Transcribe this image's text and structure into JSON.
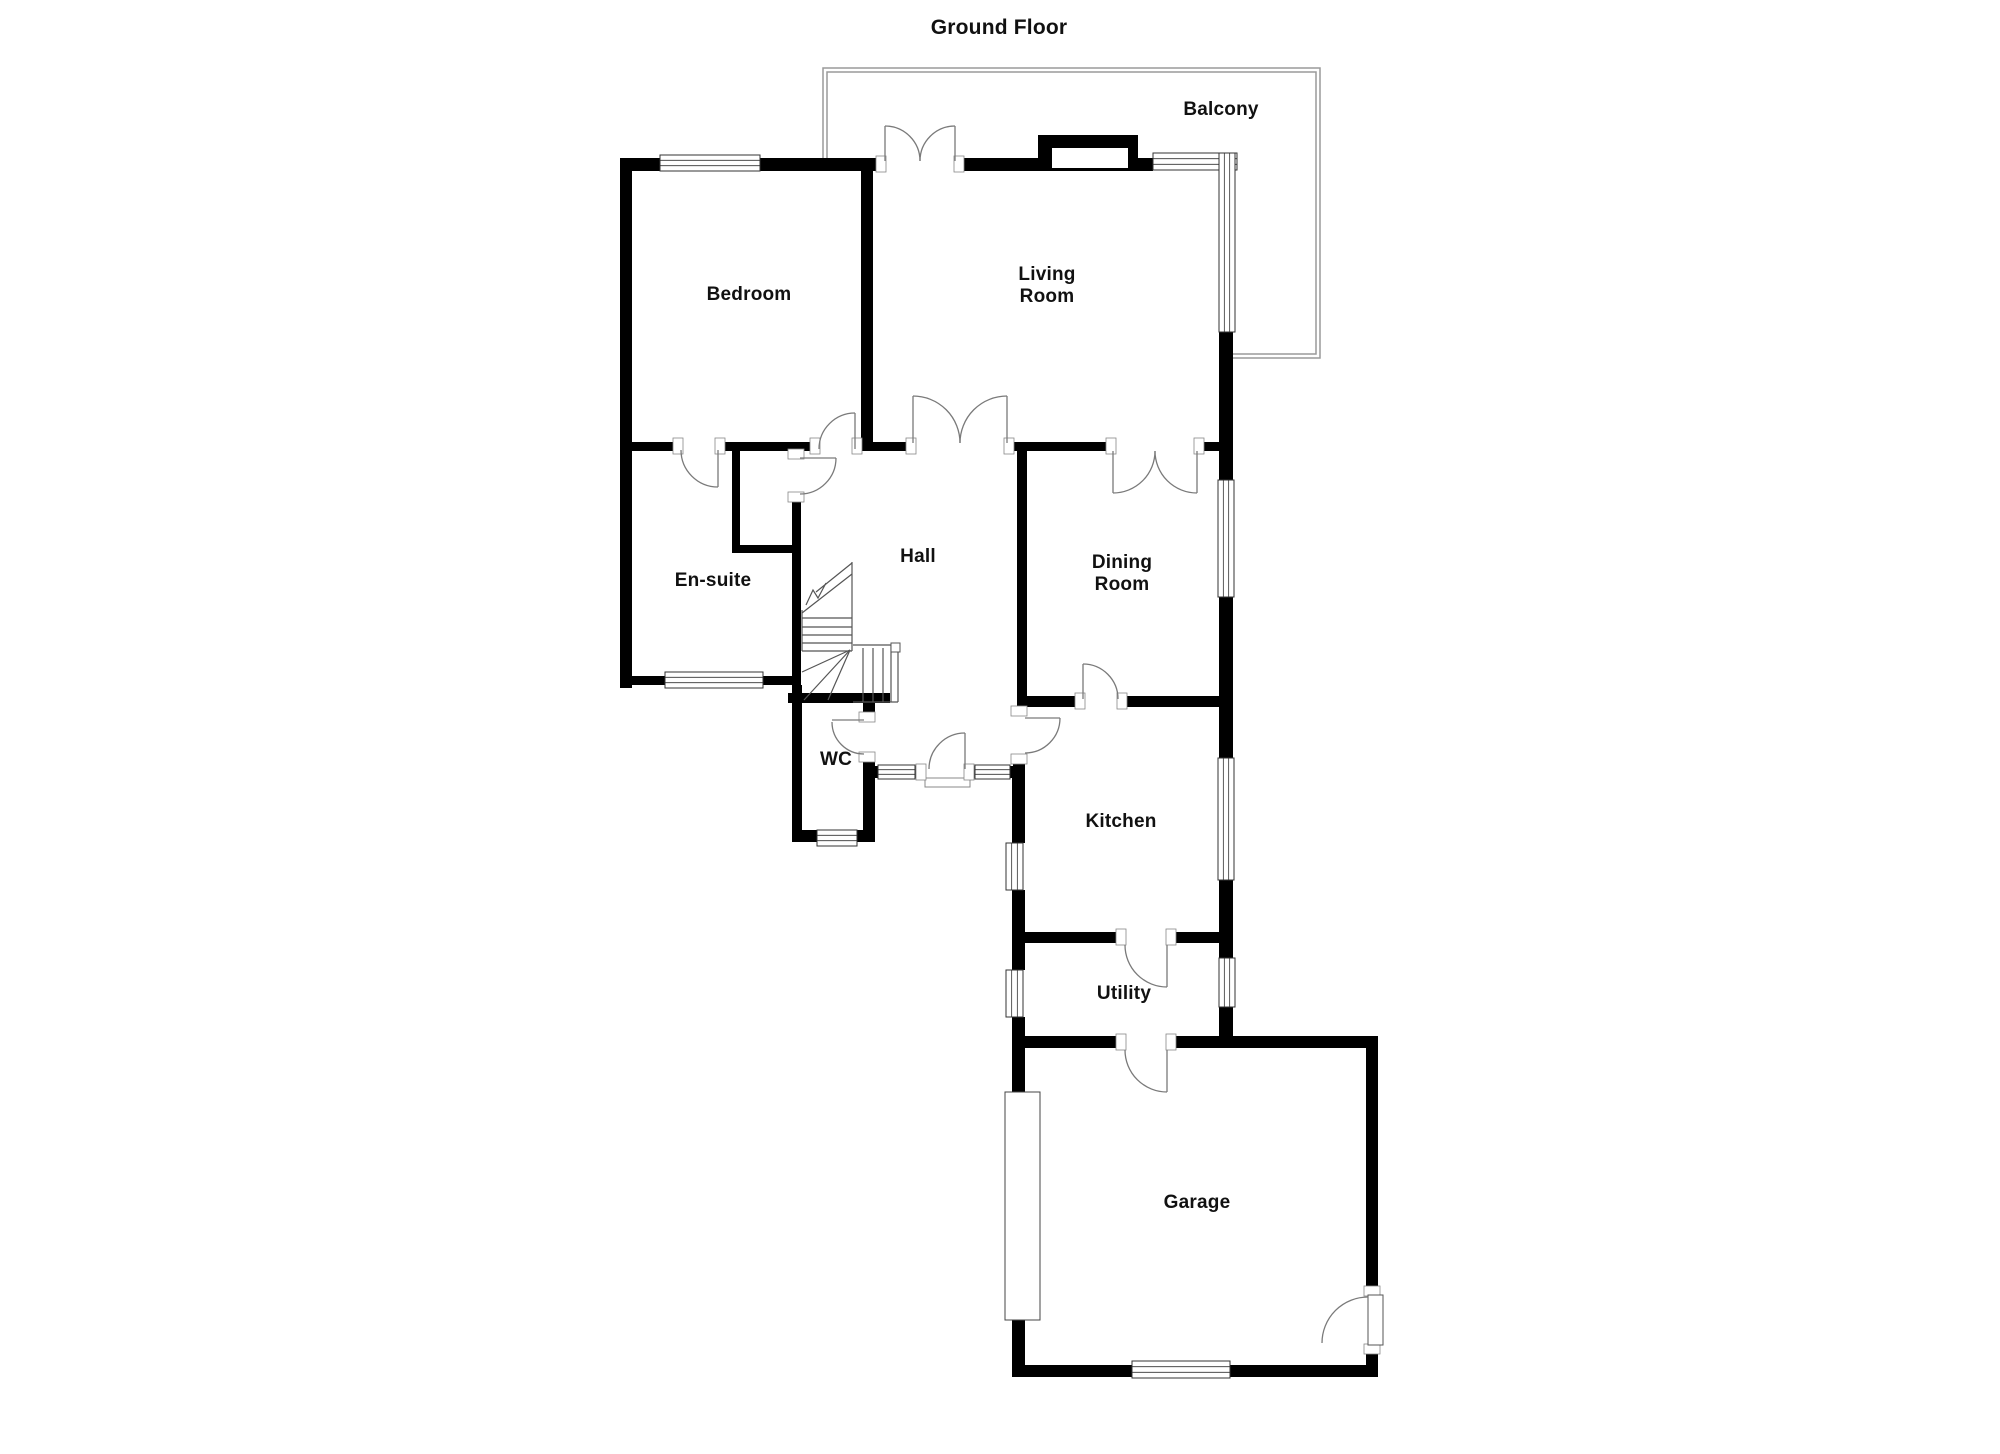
{
  "labels": [
    {
      "key": "title",
      "text": "Ground Floor",
      "x": 999,
      "y": 28
    },
    {
      "key": "balcony",
      "text": "Balcony",
      "x": 1221,
      "y": 110
    },
    {
      "key": "bedroom",
      "text": "Bedroom",
      "x": 749,
      "y": 295
    },
    {
      "key": "living",
      "text": "Living\nRoom",
      "x": 1047,
      "y": 286
    },
    {
      "key": "ensuite",
      "text": "En-suite",
      "x": 713,
      "y": 581
    },
    {
      "key": "hall",
      "text": "Hall",
      "x": 918,
      "y": 557
    },
    {
      "key": "dining",
      "text": "Dining\nRoom",
      "x": 1122,
      "y": 574
    },
    {
      "key": "wc",
      "text": "WC",
      "x": 836,
      "y": 760
    },
    {
      "key": "kitchen",
      "text": "Kitchen",
      "x": 1121,
      "y": 822
    },
    {
      "key": "utility",
      "text": "Utility",
      "x": 1124,
      "y": 994
    },
    {
      "key": "garage",
      "text": "Garage",
      "x": 1197,
      "y": 1203
    }
  ],
  "plan": {
    "background": "#ffffff",
    "wall_color": "#000000",
    "line_color": "#555555",
    "arc_color": "#7a7a7a",
    "window_color": "#333333",
    "balcony_color": "#9a9a9a",
    "walls": [
      [
        620,
        158,
        12,
        530
      ],
      [
        620,
        158,
        260,
        13
      ],
      [
        957,
        158,
        81,
        13
      ],
      [
        1138,
        158,
        15,
        13
      ],
      [
        861,
        168,
        12,
        283
      ],
      [
        620,
        442,
        60,
        9
      ],
      [
        718,
        442,
        99,
        9
      ],
      [
        855,
        442,
        58,
        9
      ],
      [
        1007,
        442,
        106,
        9
      ],
      [
        1197,
        442,
        36,
        9
      ],
      [
        732,
        450,
        8,
        103
      ],
      [
        732,
        545,
        66,
        8
      ],
      [
        792,
        450,
        9,
        8
      ],
      [
        792,
        493,
        9,
        192
      ],
      [
        620,
        676,
        180,
        9
      ],
      [
        792,
        685,
        10,
        157
      ],
      [
        792,
        830,
        81,
        12
      ],
      [
        863,
        700,
        12,
        22
      ],
      [
        863,
        753,
        12,
        89
      ],
      [
        788,
        693,
        102,
        10
      ],
      [
        875,
        766,
        5,
        12
      ],
      [
        915,
        766,
        10,
        12
      ],
      [
        965,
        766,
        10,
        12
      ],
      [
        1010,
        766,
        13,
        12
      ],
      [
        1017,
        442,
        10,
        265
      ],
      [
        1017,
        696,
        65,
        11
      ],
      [
        1118,
        696,
        114,
        11
      ],
      [
        1013,
        707,
        12,
        9
      ],
      [
        1013,
        755,
        12,
        23
      ],
      [
        1012,
        777,
        13,
        66
      ],
      [
        1012,
        890,
        13,
        80
      ],
      [
        1012,
        1017,
        13,
        31
      ],
      [
        1012,
        932,
        113,
        11
      ],
      [
        1167,
        932,
        66,
        11
      ],
      [
        1219,
        330,
        14,
        150
      ],
      [
        1219,
        597,
        14,
        161
      ],
      [
        1219,
        880,
        14,
        78
      ],
      [
        1219,
        1007,
        14,
        41
      ],
      [
        1012,
        1036,
        113,
        12
      ],
      [
        1167,
        1036,
        211,
        12
      ],
      [
        1366,
        1036,
        12,
        259
      ],
      [
        1366,
        1345,
        12,
        32
      ],
      [
        1012,
        1365,
        120,
        12
      ],
      [
        1230,
        1365,
        148,
        12
      ],
      [
        1012,
        1048,
        13,
        44
      ],
      [
        1012,
        1320,
        13,
        57
      ]
    ],
    "chimney": {
      "outer": [
        1038,
        135,
        100,
        36
      ],
      "inner": [
        1052,
        148,
        76,
        20
      ]
    },
    "windows": [
      [
        660,
        155,
        100,
        16,
        "h"
      ],
      [
        1153,
        153,
        84,
        17,
        "h"
      ],
      [
        1219,
        153,
        16,
        179,
        "v"
      ],
      [
        1218,
        480,
        16,
        117,
        "v"
      ],
      [
        1218,
        758,
        16,
        122,
        "v"
      ],
      [
        1219,
        958,
        16,
        49,
        "v"
      ],
      [
        1006,
        843,
        17,
        47,
        "v"
      ],
      [
        1006,
        970,
        17,
        47,
        "v"
      ],
      [
        665,
        672,
        98,
        16,
        "h"
      ],
      [
        817,
        830,
        40,
        16,
        "h"
      ],
      [
        878,
        765,
        37,
        14,
        "h"
      ],
      [
        975,
        765,
        35,
        14,
        "h"
      ],
      [
        1132,
        1361,
        98,
        17,
        "h"
      ]
    ],
    "garage_door": [
      1005,
      1092,
      35,
      228
    ],
    "threshold": [
      925,
      778,
      45,
      9
    ],
    "jambs": [
      [
        881,
        164,
        "h"
      ],
      [
        959,
        164,
        "h"
      ],
      [
        911,
        446,
        "h"
      ],
      [
        1009,
        446,
        "h"
      ],
      [
        1111,
        446,
        "h"
      ],
      [
        1199,
        446,
        "h"
      ],
      [
        815,
        446,
        "h"
      ],
      [
        857,
        446,
        "h"
      ],
      [
        678,
        446,
        "h"
      ],
      [
        720,
        446,
        "h"
      ],
      [
        796,
        454,
        "v"
      ],
      [
        796,
        497,
        "v"
      ],
      [
        867,
        717,
        "v"
      ],
      [
        867,
        757,
        "v"
      ],
      [
        921,
        772,
        "h"
      ],
      [
        969,
        772,
        "h"
      ],
      [
        1019,
        711,
        "v"
      ],
      [
        1019,
        759,
        "v"
      ],
      [
        1080,
        701,
        "h"
      ],
      [
        1122,
        701,
        "h"
      ],
      [
        1121,
        937,
        "h"
      ],
      [
        1171,
        937,
        "h"
      ],
      [
        1121,
        1042,
        "h"
      ],
      [
        1171,
        1042,
        "h"
      ],
      [
        1372,
        1291,
        "v"
      ],
      [
        1372,
        1349,
        "v"
      ]
    ],
    "doors": [
      {
        "name": "balcony-left",
        "arc": "M885,126 A35,35 0 0 1 920,161",
        "leaf": [
          885,
          161,
          885,
          126
        ]
      },
      {
        "name": "balcony-right",
        "arc": "M955,126 A35,35 0 0 0 920,161",
        "leaf": [
          955,
          161,
          955,
          126
        ]
      },
      {
        "name": "living-left",
        "arc": "M913,396 A47,47 0 0 1 960,443",
        "leaf": [
          913,
          443,
          913,
          396
        ]
      },
      {
        "name": "living-right",
        "arc": "M1007,396 A47,47 0 0 0 960,443",
        "leaf": [
          1007,
          443,
          1007,
          396
        ]
      },
      {
        "name": "dining-left",
        "arc": "M1113,493 A42,42 0 0 0 1155,451",
        "leaf": [
          1113,
          451,
          1113,
          493
        ]
      },
      {
        "name": "dining-right",
        "arc": "M1197,493 A42,42 0 0 1 1155,451",
        "leaf": [
          1197,
          451,
          1197,
          493
        ]
      },
      {
        "name": "bedroom",
        "arc": "M855,413 A36,36 0 0 0 819,449",
        "leaf": [
          855,
          449,
          855,
          413
        ]
      },
      {
        "name": "ensuite",
        "arc": "M718,487 A37,37 0 0 1 681,450",
        "leaf": [
          718,
          450,
          718,
          487
        ]
      },
      {
        "name": "cupboard",
        "arc": "M836,458 A36,36 0 0 1 800,494",
        "leaf": [
          800,
          458,
          836,
          458
        ]
      },
      {
        "name": "wc",
        "arc": "M832,722 A32,32 0 0 0 864,754",
        "leaf": [
          832,
          720,
          864,
          720
        ]
      },
      {
        "name": "front-entrance",
        "arc": "M965,733 A36,36 0 0 0 929,769",
        "leaf": [
          965,
          769,
          965,
          733
        ]
      },
      {
        "name": "kitchen",
        "arc": "M1060,718 A35,35 0 0 1 1025,753",
        "leaf": [
          1025,
          718,
          1060,
          718
        ]
      },
      {
        "name": "dining-kitchen",
        "arc": "M1083,664 A35,35 0 0 1 1118,699",
        "leaf": [
          1083,
          699,
          1083,
          664
        ]
      },
      {
        "name": "utility",
        "arc": "M1125,945 A42,42 0 0 0 1167,987",
        "leaf": [
          1167,
          945,
          1167,
          987
        ]
      },
      {
        "name": "utility-garage",
        "arc": "M1125,1050 A42,42 0 0 0 1167,1092",
        "leaf": [
          1167,
          1050,
          1167,
          1092
        ]
      },
      {
        "name": "garage-side",
        "arc": "M1368,1297 A46,46 0 0 0 1322,1343",
        "leaf": null,
        "leaf_rect": [
          1368,
          1295,
          15,
          50
        ]
      }
    ],
    "stairs": {
      "lines": [
        [
          802,
          610,
          802,
          651
        ],
        [
          852,
          562,
          852,
          651
        ],
        [
          802,
          651,
          852,
          651
        ],
        [
          802,
          618,
          852,
          618
        ],
        [
          802,
          627,
          852,
          627
        ],
        [
          802,
          635,
          852,
          635
        ],
        [
          802,
          643,
          852,
          643
        ],
        [
          802,
          613,
          852,
          574
        ],
        [
          816,
          592,
          852,
          563
        ],
        [
          853,
          645,
          891,
          645
        ],
        [
          891,
          645,
          891,
          702
        ],
        [
          898,
          643,
          898,
          702
        ],
        [
          853,
          702,
          898,
          702
        ],
        [
          863,
          648,
          863,
          702
        ],
        [
          873,
          648,
          873,
          702
        ],
        [
          883,
          648,
          883,
          702
        ],
        [
          850,
          650,
          802,
          672
        ],
        [
          850,
          650,
          804,
          700
        ],
        [
          850,
          650,
          828,
          700
        ]
      ],
      "zigzag": [
        [
          806,
          605
        ],
        [
          813,
          590
        ],
        [
          818,
          598
        ],
        [
          826,
          583
        ]
      ],
      "newel": [
        891,
        643,
        9,
        9
      ]
    },
    "balcony": {
      "outer": [
        [
          823,
          160
        ],
        [
          823,
          68
        ],
        [
          1320,
          68
        ],
        [
          1320,
          358
        ],
        [
          1232,
          358
        ]
      ],
      "inner": [
        [
          827,
          160
        ],
        [
          827,
          72
        ],
        [
          1316,
          72
        ],
        [
          1316,
          354
        ],
        [
          1232,
          354
        ]
      ]
    }
  }
}
